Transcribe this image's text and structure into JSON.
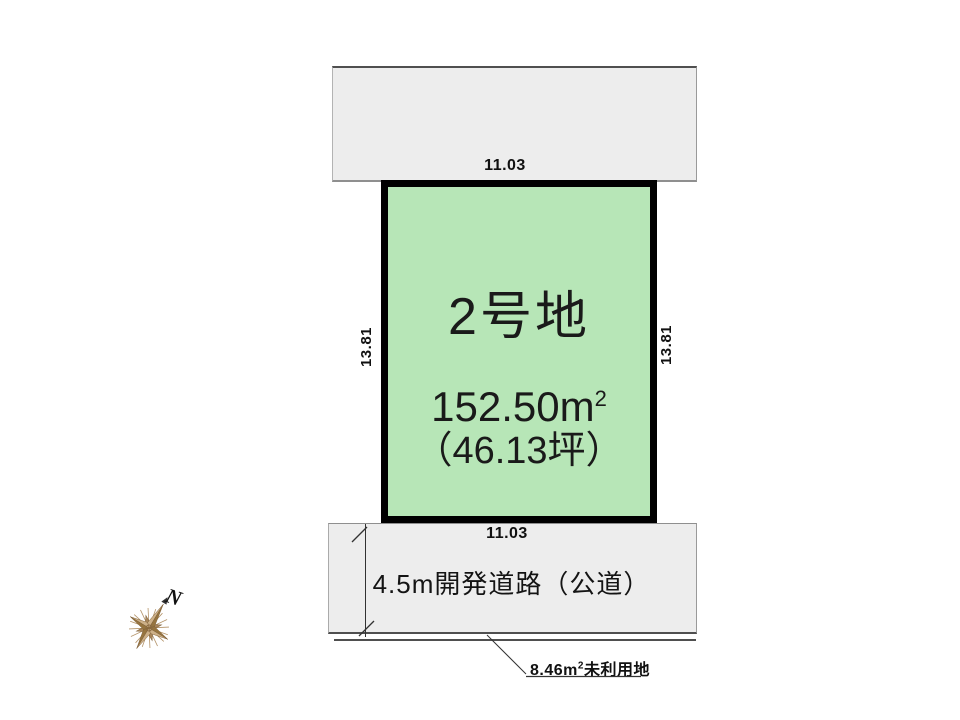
{
  "colors": {
    "lot_fill": "#b7e6b7",
    "band_fill": "#ededed",
    "outline": "#000000",
    "dark_line": "#4f4f4f",
    "compass_tan": "#a8855a"
  },
  "lot": {
    "name": "2号地",
    "area_value": "152.50",
    "area_unit_base": "m",
    "area_unit_exp": "2",
    "area_tsubo": "（46.13坪）"
  },
  "dimensions": {
    "top": "11.03",
    "bottom": "11.03",
    "left": "13.81",
    "right": "13.81"
  },
  "road": {
    "label": "4.5m開発道路（公道）"
  },
  "unused_land": {
    "value": "8.46",
    "unit_base": "m",
    "unit_exp": "2",
    "label": "未利用地"
  },
  "compass": {
    "north_label": "N"
  }
}
